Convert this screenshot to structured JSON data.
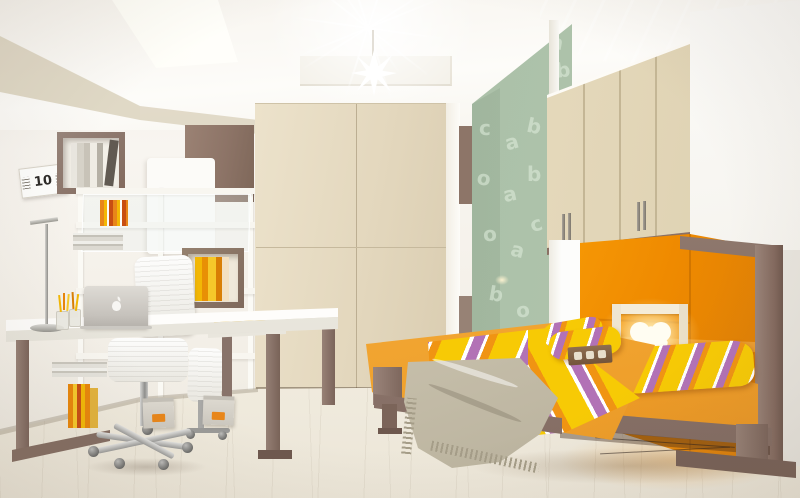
{
  "scene": {
    "title": "Kids bedroom interior render with fold-away twin beds, study desk and wardrobe",
    "calendar": {
      "day": "10"
    },
    "wallpaper": {
      "pattern": "alphabet-letters",
      "letters": [
        "a",
        "b",
        "o",
        "c",
        "a",
        "b",
        "o",
        "a",
        "b",
        "o",
        "a",
        "c",
        "b",
        "o"
      ]
    },
    "palette": {
      "wall_white": "#f6f3ee",
      "wardrobe_cream": "#e5d9bc",
      "frame_taupe": "#8d7568",
      "accent_panel_brown": "#8d7467",
      "green_wall": "#a9bfa7",
      "orange_alcove": "#f89c07",
      "bed_orange": "#f3a835",
      "stripe_yellow": "#f7ca05",
      "stripe_purple": "#b272b6",
      "stripe_orange": "#f09413",
      "throw_gray": "#cfc8b4",
      "floor_wood": "#efe9dd",
      "pencilcase_yellow": "#f6c113"
    },
    "objects": {
      "laptop": "silver laptop with apple logo",
      "lamp": "heart-shaped glowing lamp in white wall niche",
      "ceiling_light": "starburst pendant lamp",
      "skylight": "rectangular ceiling skylight"
    }
  }
}
